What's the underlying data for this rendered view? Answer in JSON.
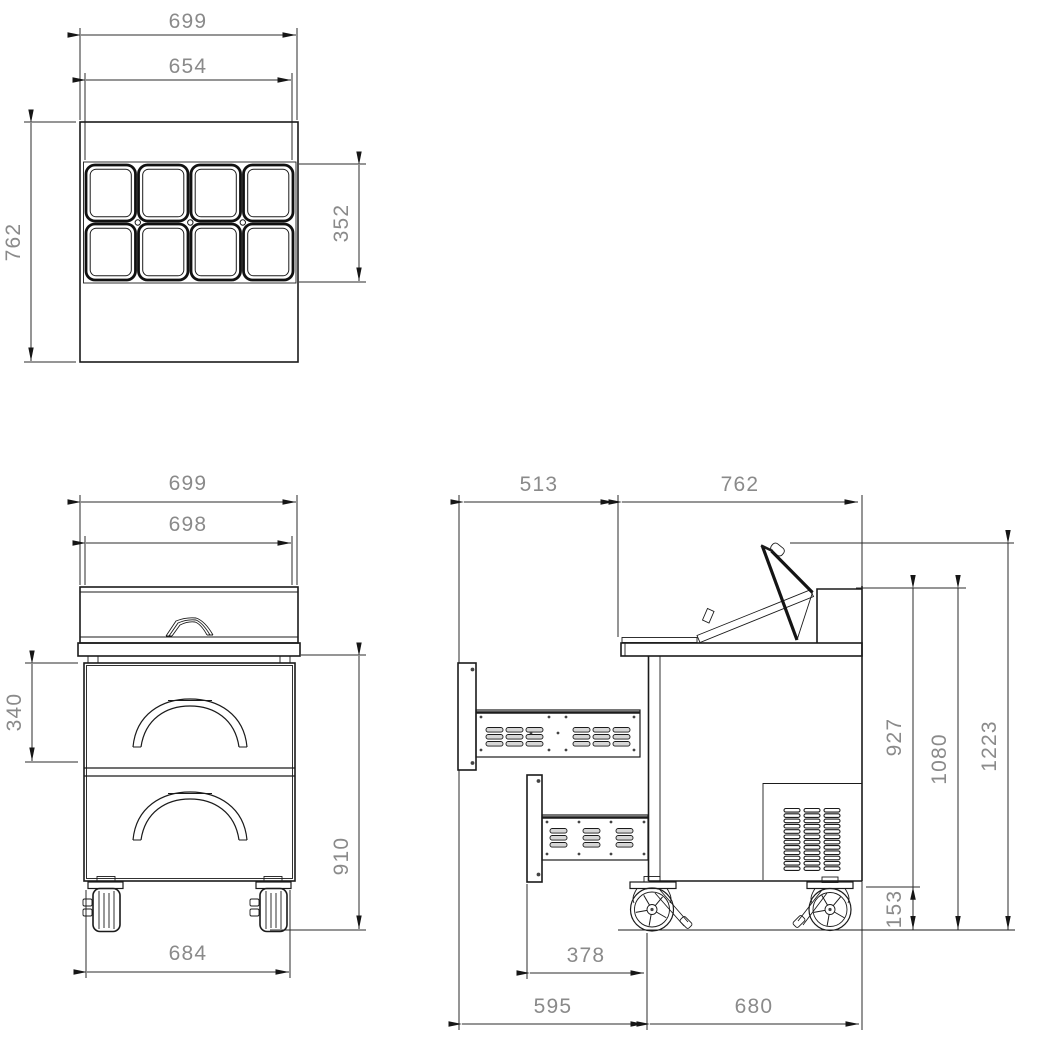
{
  "palette": {
    "line": "#1b1b1b",
    "dim_line": "#2b2b2b",
    "dim_text": "#8a8a8a",
    "background": "#ffffff"
  },
  "views": {
    "plan": {
      "dims": {
        "overall_width": "699",
        "pan_field_width": "654",
        "overall_depth": "762",
        "pan_field_depth": "352"
      }
    },
    "front": {
      "dims": {
        "overall_width": "699",
        "body_width": "698",
        "drawer_front_height": "340",
        "body_height": "910",
        "caster_spacing": "684"
      }
    },
    "side": {
      "dims": {
        "rear_overhang": "513",
        "body_depth": "762",
        "worktop_height": "927",
        "rear_rail_height": "1080",
        "lid_open_height": "1223",
        "underbody_clearance": "153",
        "vent_box_depth": "378",
        "rear_total_depth": "595",
        "lower_body_depth": "680"
      }
    }
  }
}
